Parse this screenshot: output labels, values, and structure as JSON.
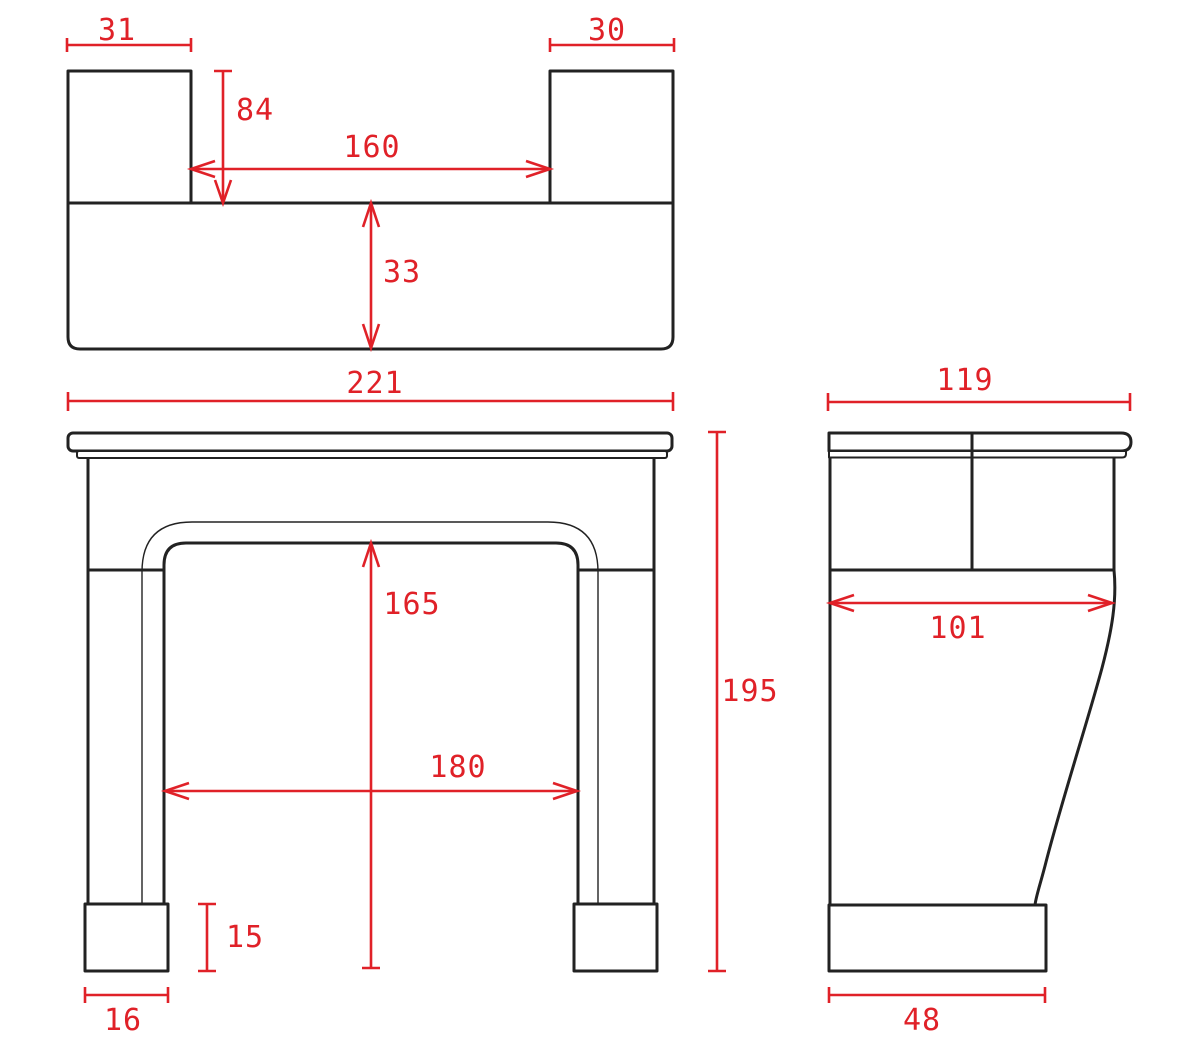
{
  "colors": {
    "dimension_red": "#e02128",
    "line_black": "#222222",
    "background": "#ffffff"
  },
  "plan_view": {
    "left_block_width": "31",
    "right_block_width": "30",
    "block_depth": "84",
    "gap_between_blocks": "160",
    "base_depth": "33"
  },
  "front_view": {
    "overall_width": "221",
    "overall_height": "195",
    "opening_height": "165",
    "opening_width": "180",
    "foot_height": "15",
    "foot_width": "16"
  },
  "side_view": {
    "shelf_depth": "119",
    "body_depth": "101",
    "foot_depth": "48"
  }
}
